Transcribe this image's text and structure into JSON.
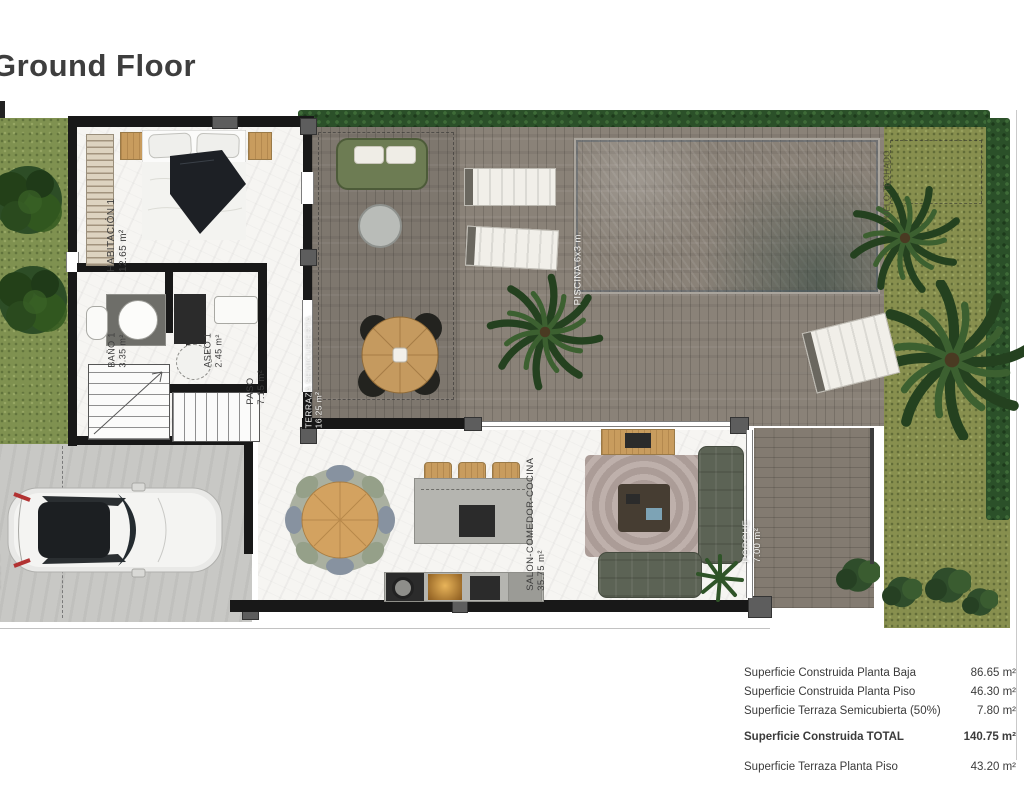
{
  "title": "Ground Floor",
  "rooms": {
    "habitacion1": {
      "name": "HABITACIÓN 1",
      "area": "12.65 m²"
    },
    "bano1": {
      "name": "BAÑO 1",
      "area": "3.35 m²"
    },
    "aseo1": {
      "name": "ASEO 1",
      "area": "2.45 m²"
    },
    "paso": {
      "name": "PASO",
      "area": "7.15 m²"
    },
    "terraza": {
      "name": "TERRAZA SEMICUBIERTA",
      "area": "16.25 m²"
    },
    "salon": {
      "name": "SALON-COMEDOR-COCINA",
      "area": "35.75 m²"
    },
    "garaje": {
      "name": "GARAJE SEMICUBIERTO",
      "area": "13.10 m²"
    },
    "porche": {
      "name": "PORCHE",
      "area": "7.00 m²"
    },
    "piscina": {
      "name": "PISCINA 6x3 m."
    },
    "garden_note": {
      "name": "VUELO TECHADO"
    }
  },
  "summary": {
    "rows": [
      {
        "label": "Superficie Construida Planta Baja",
        "value": "86.65 m²"
      },
      {
        "label": "Superficie Construida Planta Piso",
        "value": "46.30 m²"
      },
      {
        "label": "Superficie Terraza Semicubierta (50%)",
        "value": "7.80 m²"
      },
      {
        "label": "Superficie Construida TOTAL",
        "value": "140.75 m²"
      },
      {
        "label": "Superficie Terraza Planta Piso",
        "value": "43.20 m²"
      }
    ]
  },
  "colors": {
    "wall": "#181818",
    "pool_blue": "#85a9c6",
    "deck_wood": "#8a8278",
    "grass": "#7f9150",
    "hedge": "#2b5029",
    "concrete": "#c8c8c5",
    "text": "#3b3b3b"
  }
}
